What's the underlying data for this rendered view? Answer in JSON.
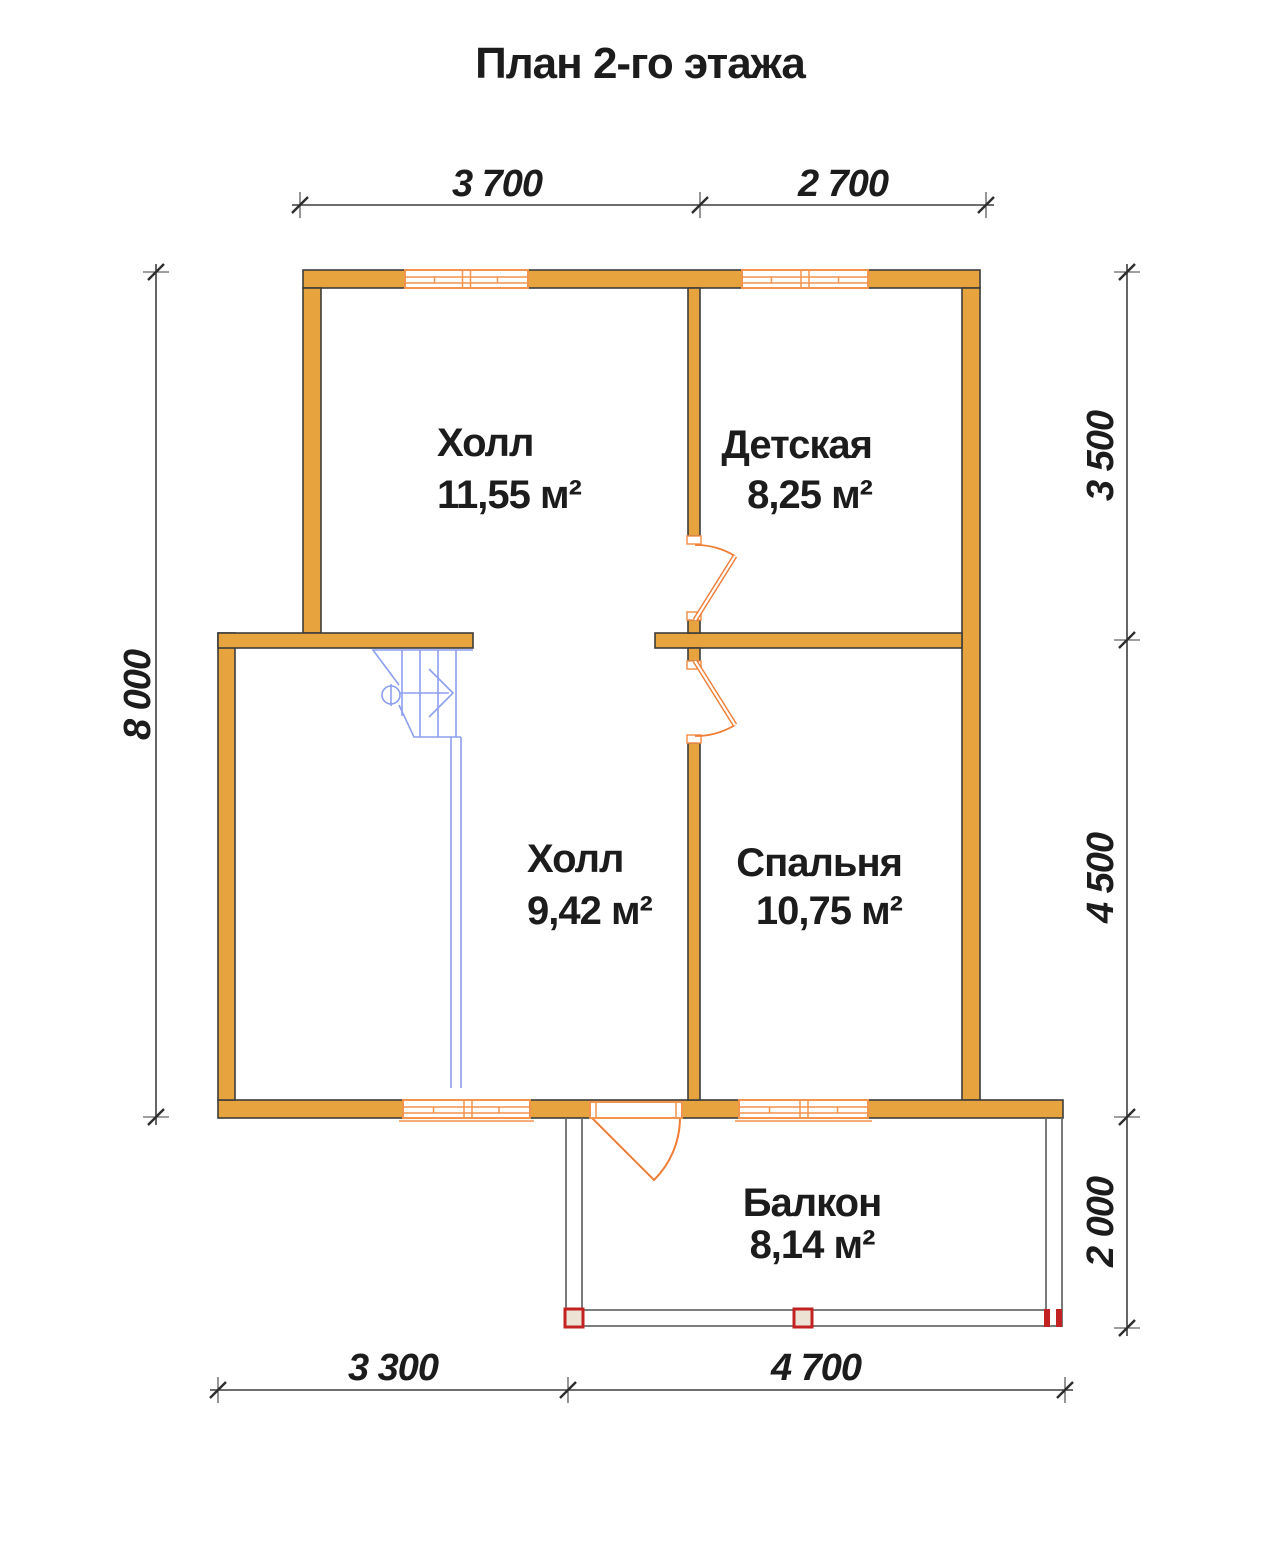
{
  "title": "План 2-го этажа",
  "rooms": {
    "hall_upper": {
      "name": "Холл",
      "area": "11,55 м²"
    },
    "nursery": {
      "name": "Детская",
      "area": "8,25 м²"
    },
    "hall_lower": {
      "name": "Холл",
      "area": "9,42 м²"
    },
    "bedroom": {
      "name": "Спальня",
      "area": "10,75 м²"
    },
    "balcony": {
      "name": "Балкон",
      "area": "8,14 м²"
    }
  },
  "dimensions": {
    "top_left": "3 700",
    "top_right": "2 700",
    "left": "8 000",
    "right_upper": "3 500",
    "right_middle": "4 500",
    "right_lower": "2 000",
    "bottom_left": "3 300",
    "bottom_right": "4 700"
  },
  "colors": {
    "wall_fill": "#E7A33D",
    "wall_outline": "#3D3D3D",
    "window_frame": "#F2934E",
    "door": "#EF7D35",
    "stairs": "#8D9FEF",
    "balcony_rail": "#6B6B6B",
    "post_red": "#C32222",
    "dimension_line": "#3F3F3F",
    "text": "#1C1C1C",
    "background": "#FFFFFF"
  }
}
